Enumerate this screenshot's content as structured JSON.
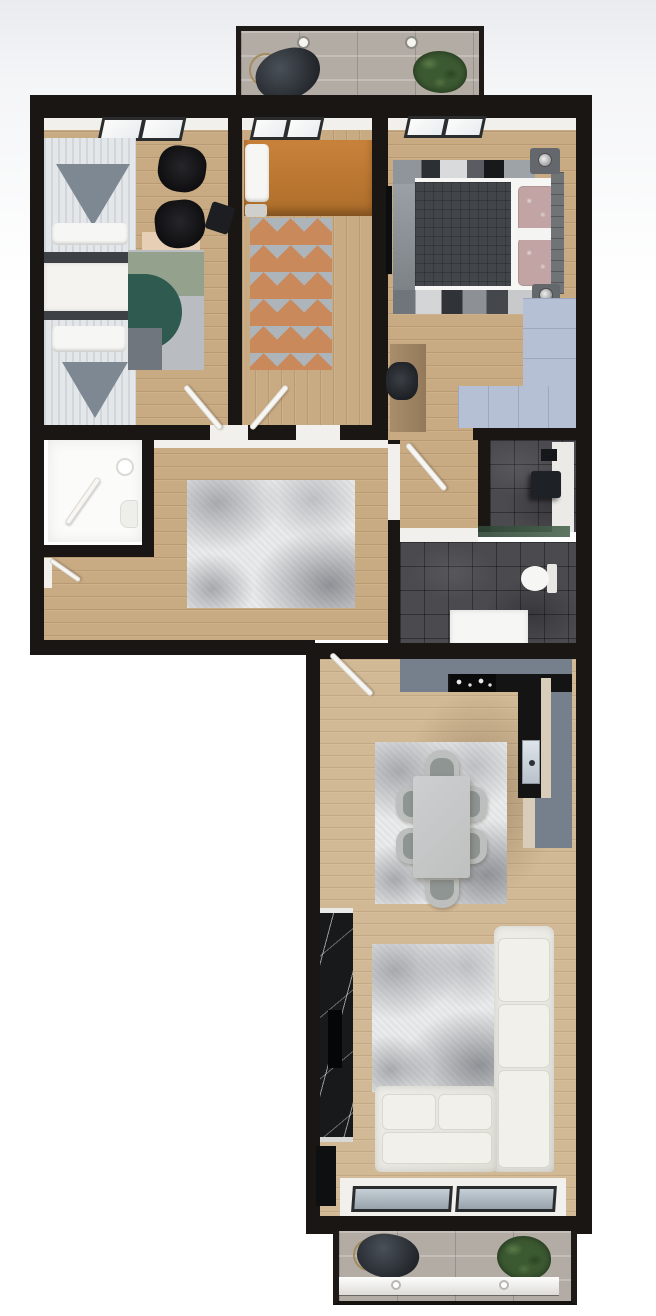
{
  "scene": {
    "kind": "3d-floor-plan-top-view",
    "rooms": [
      {
        "id": "balcony-top",
        "furniture": [
          "hanging-chair",
          "plant",
          "ceiling-light",
          "ceiling-light"
        ]
      },
      {
        "id": "bedroom-left",
        "furniture": [
          "single-bed",
          "single-bed",
          "dresser",
          "office-chair",
          "office-chair",
          "stool",
          "desk",
          "area-rug",
          "window",
          "door"
        ]
      },
      {
        "id": "bedroom-middle",
        "furniture": [
          "orange-daybed",
          "pillow",
          "geometric-rug",
          "window",
          "door"
        ]
      },
      {
        "id": "bedroom-master",
        "furniture": [
          "double-bed",
          "duvet",
          "pillow",
          "pillow",
          "headboard",
          "nightstand",
          "nightstand",
          "table-lamp",
          "table-lamp",
          "wall-tv",
          "wardrobe",
          "desk",
          "desk-chair",
          "patchwork-rug",
          "window"
        ]
      },
      {
        "id": "bathroom-small",
        "furniture": [
          "sink",
          "toilet",
          "door"
        ]
      },
      {
        "id": "hallway",
        "furniture": [
          "area-rug",
          "entry-door"
        ]
      },
      {
        "id": "corridor",
        "furniture": [
          "door"
        ]
      },
      {
        "id": "bathroom-dark",
        "furniture": [
          "shower",
          "shower-tray",
          "glass-shelf",
          "toilet",
          "vanity"
        ]
      },
      {
        "id": "kitchen-living",
        "furniture": [
          "l-shaped-counter",
          "cooktop",
          "kitchen-sink",
          "dining-table",
          "dining-chair",
          "dining-chair",
          "dining-chair",
          "dining-chair",
          "dining-chair",
          "dining-chair",
          "dining-rug",
          "marble-tv-wall",
          "tv",
          "l-shaped-sofa",
          "living-rug",
          "panorama-window",
          "door"
        ]
      },
      {
        "id": "balcony-bottom",
        "furniture": [
          "hanging-chair",
          "plant",
          "railing",
          "rail-light",
          "rail-light"
        ]
      }
    ]
  },
  "colors": {
    "wall": "#1a1613",
    "wood": "#c9ab83",
    "wood_light": "#d2b995",
    "tile": "#b3aca4",
    "inner_wall": "#f2f0ec",
    "rug_hall": "#e3e4e5",
    "rug_teal": "#2e5a50",
    "rug_sage": "#94a28d",
    "rug_gray_block": "#70767e",
    "rug_light": "#b9bdc1",
    "desk_beige": "#e6cfb5",
    "linen": "#e4e7ea",
    "linen_fold": "#7e8893",
    "bed_base_dark": "#3d4145",
    "bed_orange": "#c07a33",
    "pattern_base": "#e9e4dc",
    "pattern_gray": "#aeb5ba",
    "pattern_terra": "#c9895b",
    "duvet_dark": "#42464b",
    "pillow_mauve": "#c2a4a4",
    "headboard_gray": "#717477",
    "nightstand_gray": "#64676b",
    "wardrobe_blue": "#b5c0d4",
    "bath_tile": "#4b4a4f",
    "fixture_white": "#f6f6f4",
    "counter_slate": "#75808c",
    "counter_black": "#141414",
    "cabinet_cream": "#d8cdb8",
    "glass_green": "#3c5a46",
    "table_gray": "#c6c8c7",
    "chair_gray": "#bcbfbd",
    "chair_inner": "#8f9593",
    "sofa_white": "#eae9e3",
    "marble_black": "#17191b",
    "plant_green": "#3c5a32",
    "frame_dark": "#2a2c2e",
    "leaf_white": "#f7f6f3"
  }
}
